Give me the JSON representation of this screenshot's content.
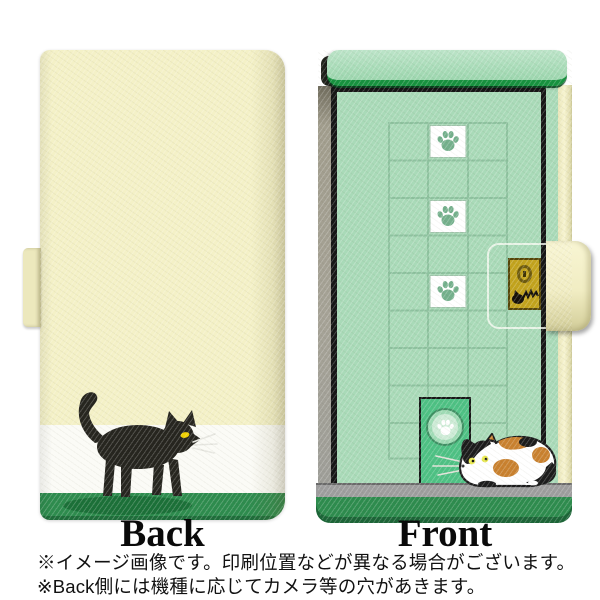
{
  "product_preview": {
    "back_label": "Back",
    "front_label": "Front",
    "disclaimer": {
      "line1": "※イメージ画像です。印刷位置などが異なる場合がございます。",
      "line2": "※Back側には機種に応じてカメラ等の穴があきます。"
    },
    "colors": {
      "case_cream": "#f4f1c7",
      "mint_green": "#a9dab8",
      "grid_line_green": "#8ec29f",
      "band_white": "#fbfbf6",
      "band_green": "#2e8c4e",
      "awning_trim_green": "#17923f",
      "pet_door_green": "#4ec184",
      "floor_gray": "#9e9e9e",
      "gold_emblem": "#c2a31d",
      "black_cat": "#26251f",
      "calico_orange": "#c9812f",
      "paw_print_green": "#74b08c",
      "cat_eye_yellow": "#f0d000"
    },
    "icons": [
      "paw-print-icon",
      "keyhole-icon",
      "cat-scratch-icon"
    ]
  }
}
